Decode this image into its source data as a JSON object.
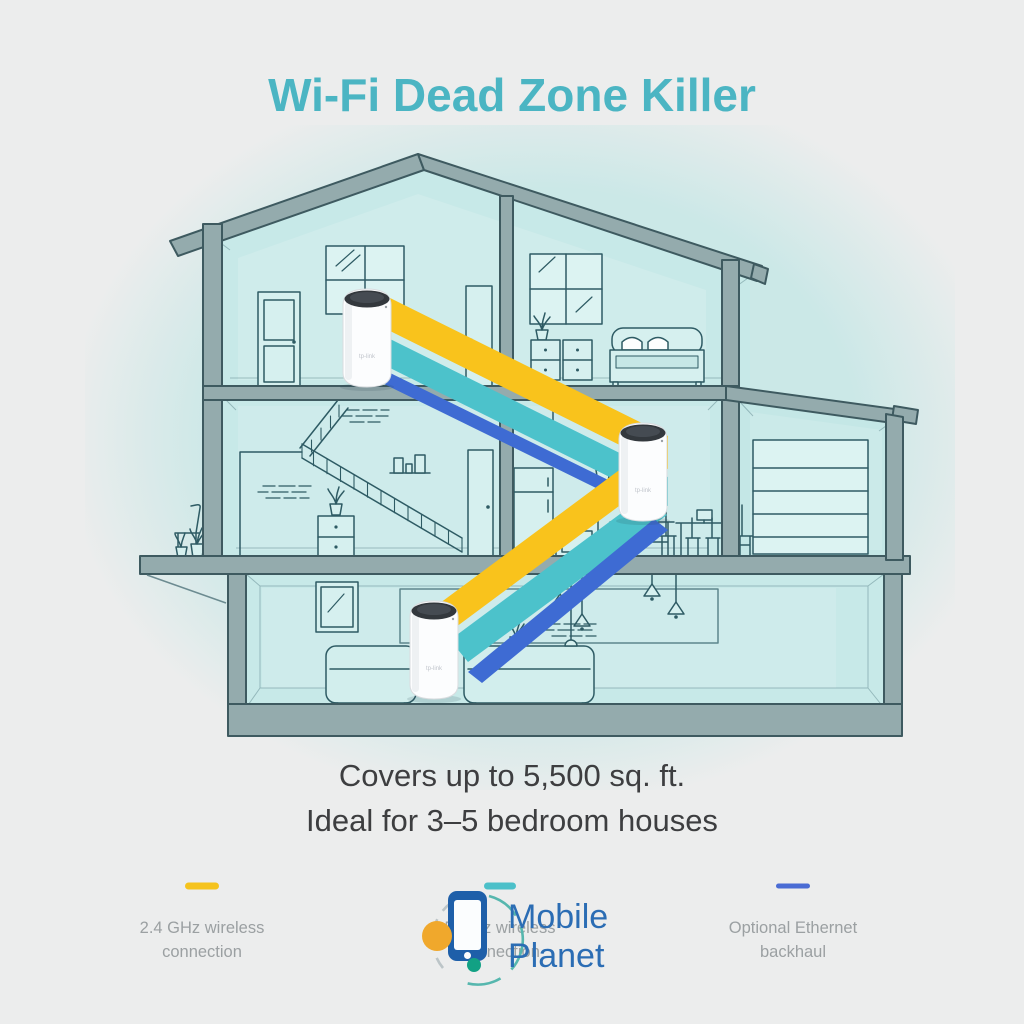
{
  "page": {
    "background_color": "#ECEDED",
    "ambient_tint_color": "#CBE8E7"
  },
  "title": {
    "text": "Wi-Fi Dead Zone Killer",
    "color": "#4BB5C3"
  },
  "subtitle": {
    "line1": "Covers up to 5,500 sq. ft.",
    "line2": "Ideal for 3–5 bedroom houses",
    "color": "#3D3E40"
  },
  "diagram": {
    "type": "house cross-section with 3-unit mesh Wi-Fi system",
    "device_count": 3,
    "device_label": "tp-link",
    "units": [
      {
        "id": "attic-unit",
        "location": "top floor left room"
      },
      {
        "id": "kitchen-unit",
        "location": "middle floor kitchen"
      },
      {
        "id": "living-room-unit",
        "location": "ground floor living room"
      }
    ],
    "connections": {
      "wireless_24ghz_color": "#F9C31C",
      "wireless_5ghz_color": "#4CC2CB",
      "ethernet_color": "#3E6BD3"
    }
  },
  "legend": {
    "text_color": "#9BA0A2",
    "items": [
      {
        "swatch_color": "#F5C31D",
        "line1": "2.4 GHz wireless",
        "line2": "connection"
      },
      {
        "swatch_color": "#4CC0C9",
        "line1": "5 GHz wireless",
        "line2": "connection"
      },
      {
        "swatch_color": "#4A6CD4",
        "line1": "Optional Ethernet",
        "line2": "backhaul"
      }
    ]
  },
  "watermark": {
    "line1": "Mobile",
    "line2": "Planet",
    "text_color": "#2B6DB4",
    "icon_colors": {
      "phone": "#1E5FA9",
      "orbit_teal": "#56B7AE",
      "orbit_gray": "#BCC5C8",
      "dot_orange": "#F0A82C",
      "dot_green": "#12A184"
    }
  }
}
